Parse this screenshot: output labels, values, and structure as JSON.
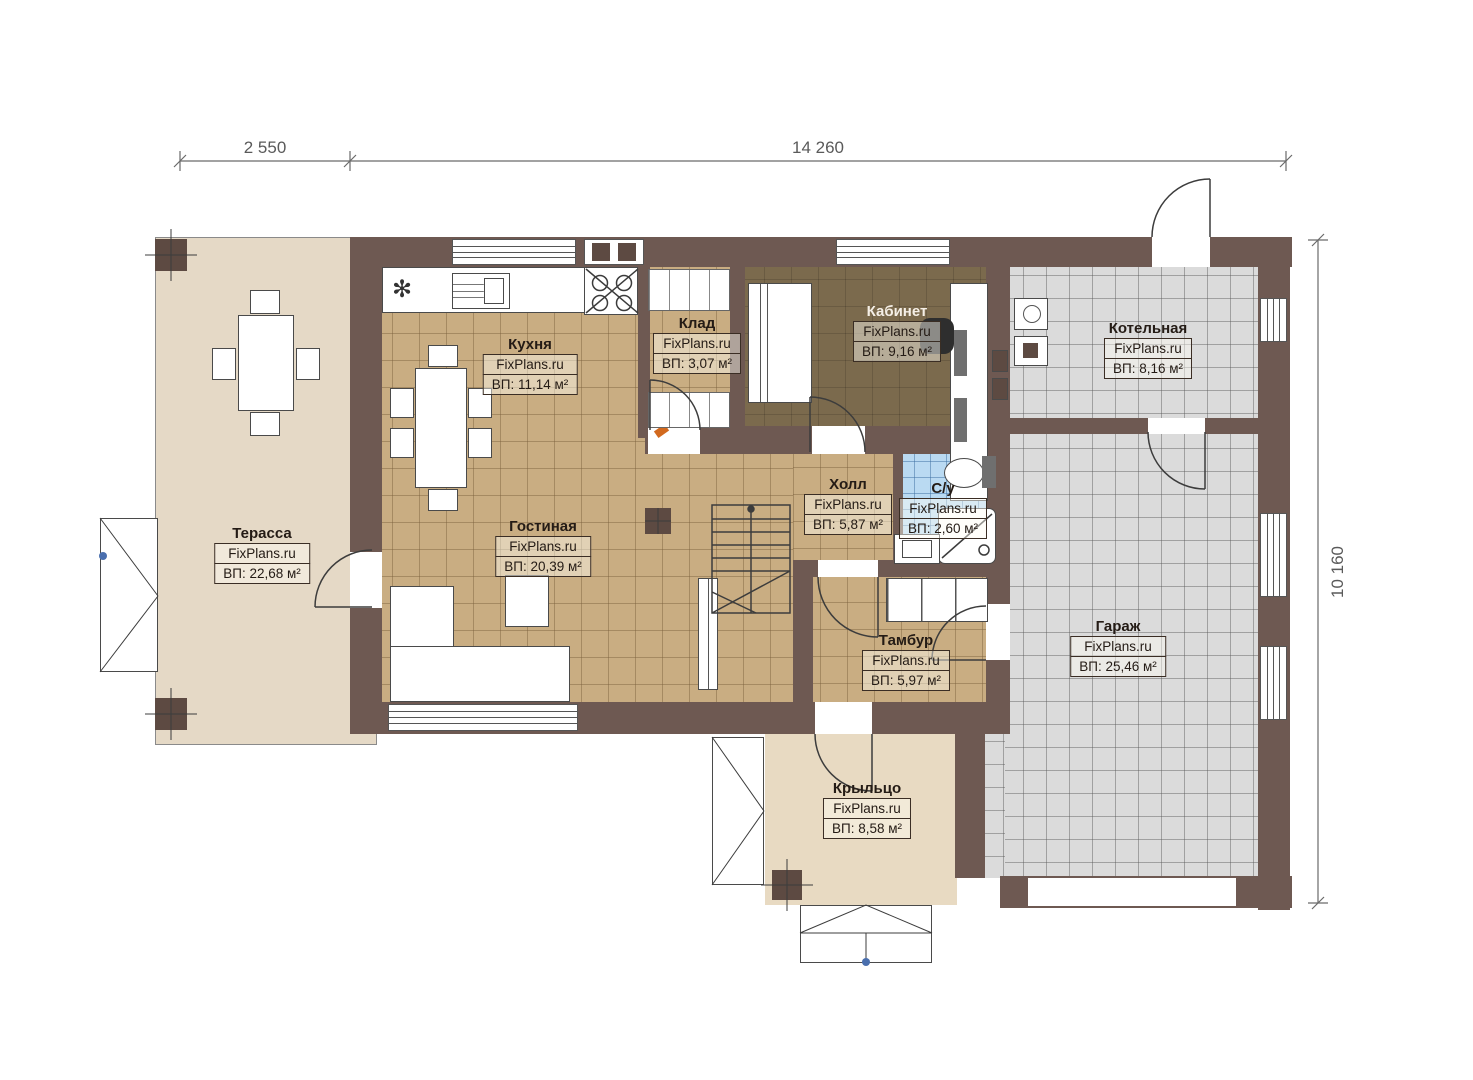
{
  "plan": {
    "brand": "FixPlans.ru",
    "dimensions": {
      "top_left": "2 550",
      "top_right": "14 260",
      "right_side": "10 160"
    },
    "rooms": [
      {
        "key": "terrace",
        "name": "Терасса",
        "brand": "FixPlans.ru",
        "area": "ВП: 22,68 м²"
      },
      {
        "key": "kitchen",
        "name": "Кухня",
        "brand": "FixPlans.ru",
        "area": "ВП: 11,14 м²"
      },
      {
        "key": "storage",
        "name": "Клад",
        "brand": "FixPlans.ru",
        "area": "ВП: 3,07 м²"
      },
      {
        "key": "office",
        "name": "Кабинет",
        "brand": "FixPlans.ru",
        "area": "ВП: 9,16 м²"
      },
      {
        "key": "boiler",
        "name": "Котельная",
        "brand": "FixPlans.ru",
        "area": "ВП: 8,16 м²"
      },
      {
        "key": "living",
        "name": "Гостиная",
        "brand": "FixPlans.ru",
        "area": "ВП: 20,39 м²"
      },
      {
        "key": "hall",
        "name": "Холл",
        "brand": "FixPlans.ru",
        "area": "ВП: 5,87 м²"
      },
      {
        "key": "wc",
        "name": "С/у",
        "brand": "FixPlans.ru",
        "area": "ВП: 2,60 м²"
      },
      {
        "key": "tambour",
        "name": "Тамбур",
        "brand": "FixPlans.ru",
        "area": "ВП: 5,97 м²"
      },
      {
        "key": "garage",
        "name": "Гараж",
        "brand": "FixPlans.ru",
        "area": "ВП: 25,46 м²"
      },
      {
        "key": "porch",
        "name": "Крыльцо",
        "brand": "FixPlans.ru",
        "area": "ВП: 8,58 м²"
      }
    ],
    "colors": {
      "wall": "#6e5952",
      "column": "#5d4a42",
      "tile_tan": "#c9ad82",
      "tile_gray": "#dbdbdb",
      "tile_blue": "#badaf2",
      "office_floor": "#7b6a4d",
      "terrace_floor": "#e5d9c6",
      "porch_floor": "#e8dac2"
    },
    "icons": [
      "fridge-snowflake-icon",
      "stove-burners-icon",
      "stair-icon",
      "door-arc-icon"
    ]
  }
}
